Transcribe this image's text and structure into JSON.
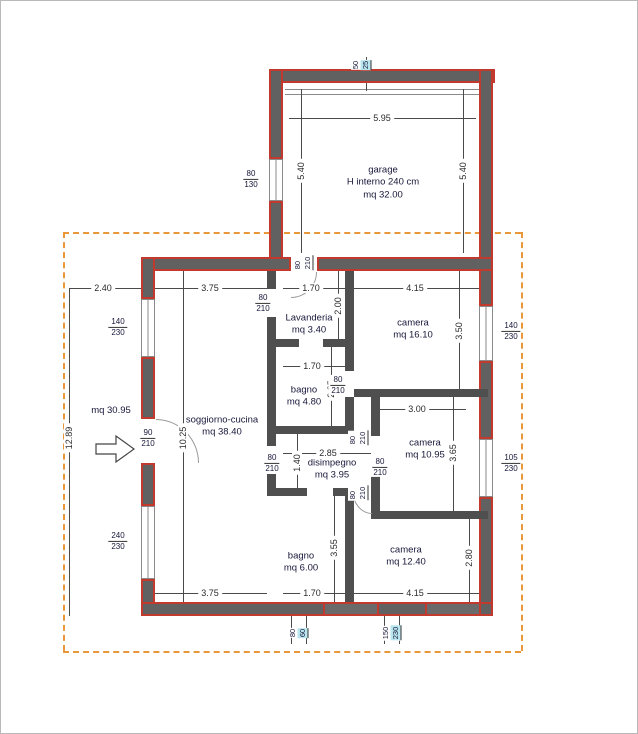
{
  "plan": {
    "rooms": {
      "garage": {
        "name": "garage",
        "detail": "H interno 240 cm",
        "area": "mq 32.00"
      },
      "lavanderia": {
        "name": "Lavanderia",
        "area": "mq 3.40"
      },
      "bagno1": {
        "name": "bagno",
        "area": "mq 4.80"
      },
      "disimpegno": {
        "name": "disimpegno",
        "area": "mq 3.95"
      },
      "bagno2": {
        "name": "bagno",
        "area": "mq 6.00"
      },
      "camera1": {
        "name": "camera",
        "area": "mq 16.10"
      },
      "camera2": {
        "name": "camera",
        "area": "mq 10.95"
      },
      "camera3": {
        "name": "camera",
        "area": "mq 12.40"
      },
      "soggiorno": {
        "name": "soggiorno-cucina",
        "area": "mq 38.40"
      },
      "ingresso": {
        "area": "mq 30.95"
      }
    },
    "dimensions": {
      "garage_width": "5.95",
      "garage_height_left": "5.40",
      "garage_height_right": "5.40",
      "top_left_offset": "2.40",
      "soggiorno_width_top": "3.75",
      "lavanderia_width": "1.70",
      "camera1_width": "4.15",
      "lavanderia_height": "2.00",
      "camera1_height": "3.50",
      "bagno1_width": "1.70",
      "bagno1_height": "2.85",
      "lot_height": "12.89",
      "soggiorno_height": "10.25",
      "disimpegno_width": "2.85",
      "disimpegno_height": "1.40",
      "camera2_width": "3.00",
      "camera2_height": "3.65",
      "bagno2_height": "3.55",
      "camera3_height": "2.80",
      "soggiorno_width_bottom": "3.75",
      "bagno2_width": "1.70",
      "camera3_width": "4.15"
    },
    "windows": {
      "garage_left": {
        "w": "80",
        "h": "130"
      },
      "left_upper": {
        "w": "140",
        "h": "230"
      },
      "left_lower": {
        "w": "240",
        "h": "230"
      },
      "right_upper": {
        "w": "140",
        "h": "230"
      },
      "right_lower": {
        "w": "105",
        "h": "230"
      },
      "bottom_left": {
        "w": "80",
        "h": "60"
      },
      "bottom_right": {
        "w": "150",
        "h": "230"
      },
      "garage_top": {
        "w": "50",
        "h": "25"
      }
    },
    "doors": {
      "entrance": {
        "w": "90",
        "h": "210"
      },
      "garage": {
        "w": "80",
        "h": "210"
      },
      "lavanderia": {
        "w": "80",
        "h": "210"
      },
      "bagno1": {
        "w": "80",
        "h": "210"
      },
      "disimpegno": {
        "w": "80",
        "h": "210"
      },
      "camera2_a": {
        "w": "80",
        "h": "210"
      },
      "camera2_b": {
        "w": "80",
        "h": "210"
      },
      "camera3": {
        "w": "80",
        "h": "210"
      }
    },
    "colors": {
      "exterior_wall_accent": "#c23a2e",
      "wall_core": "#616161",
      "lot_boundary": "#e8973a",
      "room_text": "#17173a",
      "highlight": "#b9e6ee"
    }
  }
}
